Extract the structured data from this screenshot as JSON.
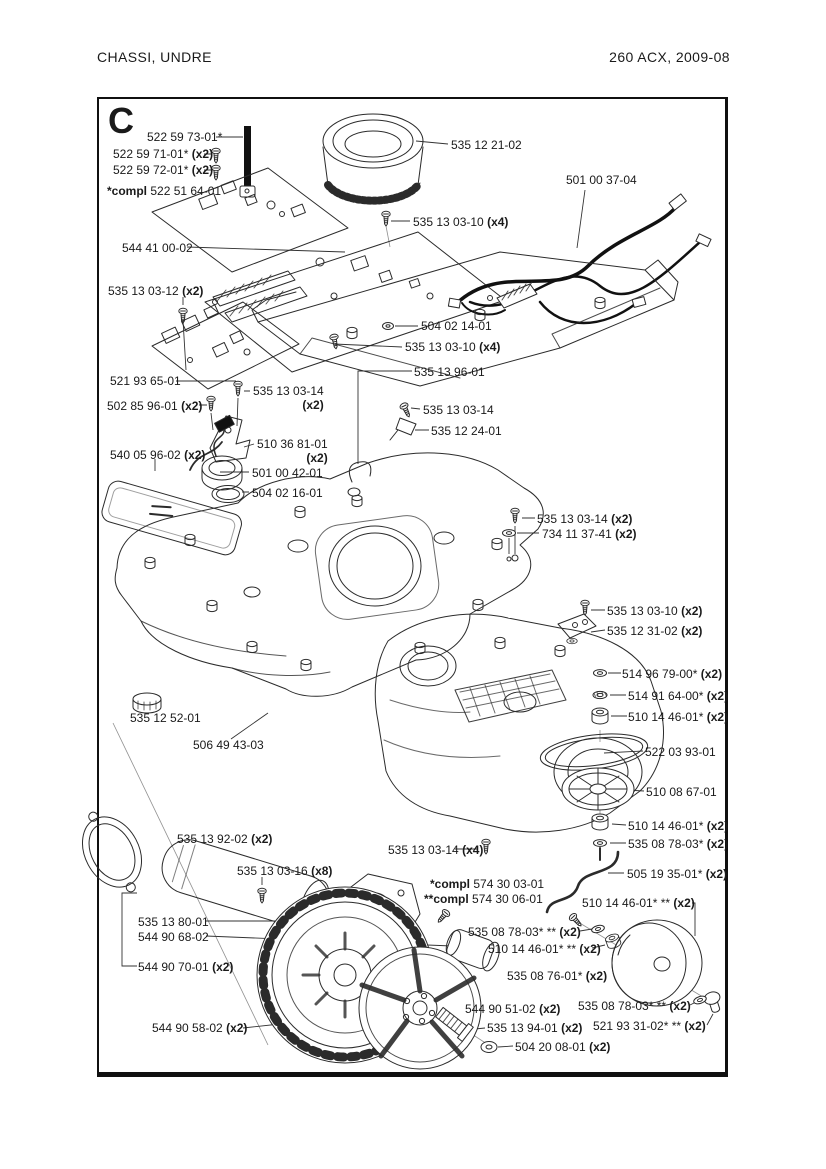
{
  "page": {
    "header_left": "CHASSI,  UNDRE",
    "header_right": "260 ACX, 2009-08",
    "section_letter": "C"
  },
  "colors": {
    "ink": "#1a1a1a",
    "line": "#2b2b2b",
    "frame": "#101010"
  },
  "diagram": {
    "labels": [
      {
        "t": "522 59 73-01*",
        "x": 147,
        "y": 130
      },
      {
        "t": "522 59 71-01*",
        "q": "(x2)",
        "x": 113,
        "y": 147
      },
      {
        "t": "522 59 72-01*",
        "q": "(x2)",
        "x": 113,
        "y": 163
      },
      {
        "b": "*compl",
        "t": "522 51 64-01",
        "x": 107,
        "y": 184
      },
      {
        "t": "544 41 00-02",
        "x": 122,
        "y": 241
      },
      {
        "t": "535 12 21-02",
        "x": 451,
        "y": 138
      },
      {
        "t": "501 00 37-04",
        "x": 566,
        "y": 173
      },
      {
        "t": "535 13 03-10",
        "q": "(x4)",
        "x": 413,
        "y": 215
      },
      {
        "t": "535 13 03-12",
        "q": "(x2)",
        "x": 108,
        "y": 284
      },
      {
        "t": "504 02 14-01",
        "x": 421,
        "y": 319
      },
      {
        "t": "535 13 03-10",
        "q": "(x4)",
        "x": 405,
        "y": 340
      },
      {
        "t": "521 93 65-01",
        "x": 110,
        "y": 374
      },
      {
        "t": "535 13 03-14",
        "q": "(x2)",
        "two": true,
        "x": 253,
        "y": 384
      },
      {
        "t": "535 13 96-01",
        "x": 414,
        "y": 365
      },
      {
        "t": "502 85 96-01",
        "q": "(x2)",
        "x": 107,
        "y": 399
      },
      {
        "t": "535 13 03-14",
        "x": 423,
        "y": 403
      },
      {
        "t": "535 12 24-01",
        "x": 431,
        "y": 424
      },
      {
        "t": "540 05 96-02",
        "q": "(x2)",
        "x": 110,
        "y": 448
      },
      {
        "t": "510 36 81-01",
        "q": "(x2)",
        "two": true,
        "x": 257,
        "y": 437
      },
      {
        "t": "501 00 42-01",
        "x": 252,
        "y": 466
      },
      {
        "t": "504 02 16-01",
        "x": 252,
        "y": 486
      },
      {
        "t": "535 13 03-14",
        "q": "(x2)",
        "x": 537,
        "y": 512
      },
      {
        "t": "734 11 37-41",
        "q": "(x2)",
        "x": 542,
        "y": 527
      },
      {
        "t": "535 13 03-10",
        "q": "(x2)",
        "x": 607,
        "y": 604
      },
      {
        "t": "535 12 31-02",
        "q": "(x2)",
        "x": 607,
        "y": 624
      },
      {
        "t": "514 96 79-00*",
        "q": "(x2)",
        "x": 622,
        "y": 667
      },
      {
        "t": "514 91 64-00*",
        "q": "(x2)",
        "x": 628,
        "y": 689
      },
      {
        "t": "510 14 46-01*",
        "q": "(x2)",
        "x": 628,
        "y": 710
      },
      {
        "t": "535 12 52-01",
        "x": 130,
        "y": 711
      },
      {
        "t": "506 49 43-03",
        "x": 193,
        "y": 738
      },
      {
        "t": "522 03 93-01",
        "x": 645,
        "y": 745
      },
      {
        "t": "510 08 67-01",
        "x": 646,
        "y": 785
      },
      {
        "t": "510 14 46-01*",
        "q": "(x2)",
        "x": 628,
        "y": 819
      },
      {
        "t": "535 08 78-03*",
        "q": "(x2)",
        "x": 628,
        "y": 837
      },
      {
        "t": "535 13 92-02",
        "q": "(x2)",
        "x": 177,
        "y": 832
      },
      {
        "t": "535 13 03-14",
        "q": "(x4)",
        "x": 388,
        "y": 843
      },
      {
        "t": "505 19 35-01*",
        "q": "(x2)",
        "x": 627,
        "y": 867
      },
      {
        "t": "535 13 03-16",
        "q": "(x8)",
        "x": 237,
        "y": 864
      },
      {
        "b": "*compl",
        "t": "574 30 03-01",
        "x": 430,
        "y": 877
      },
      {
        "b": "**compl",
        "t": "574 30 06-01",
        "x": 424,
        "y": 892
      },
      {
        "t": "510 14 46-01* **",
        "q": "(x2)",
        "x": 582,
        "y": 896
      },
      {
        "t": "535 08 78-03* **",
        "q": "(x2)",
        "x": 468,
        "y": 925
      },
      {
        "t": "510 14 46-01* **",
        "q": "(x2)",
        "x": 488,
        "y": 942
      },
      {
        "t": "535 13 80-01",
        "x": 138,
        "y": 915
      },
      {
        "t": "544 90 68-02",
        "x": 138,
        "y": 930
      },
      {
        "t": "535 08 76-01*",
        "q": "(x2)",
        "x": 507,
        "y": 969
      },
      {
        "t": "544 90 70-01",
        "q": "(x2)",
        "x": 138,
        "y": 960
      },
      {
        "t": "544 90 51-02",
        "q": "(x2)",
        "x": 465,
        "y": 1002
      },
      {
        "t": "535 08 78-03* **",
        "q": "(x2)",
        "x": 578,
        "y": 999
      },
      {
        "t": "521 93 31-02* **",
        "q": "(x2)",
        "x": 593,
        "y": 1019
      },
      {
        "t": "544 90 58-02",
        "q": "(x2)",
        "x": 152,
        "y": 1021
      },
      {
        "t": "535 13 94-01",
        "q": "(x2)",
        "x": 487,
        "y": 1021
      },
      {
        "t": "504 20 08-01",
        "q": "(x2)",
        "x": 515,
        "y": 1040
      }
    ]
  }
}
